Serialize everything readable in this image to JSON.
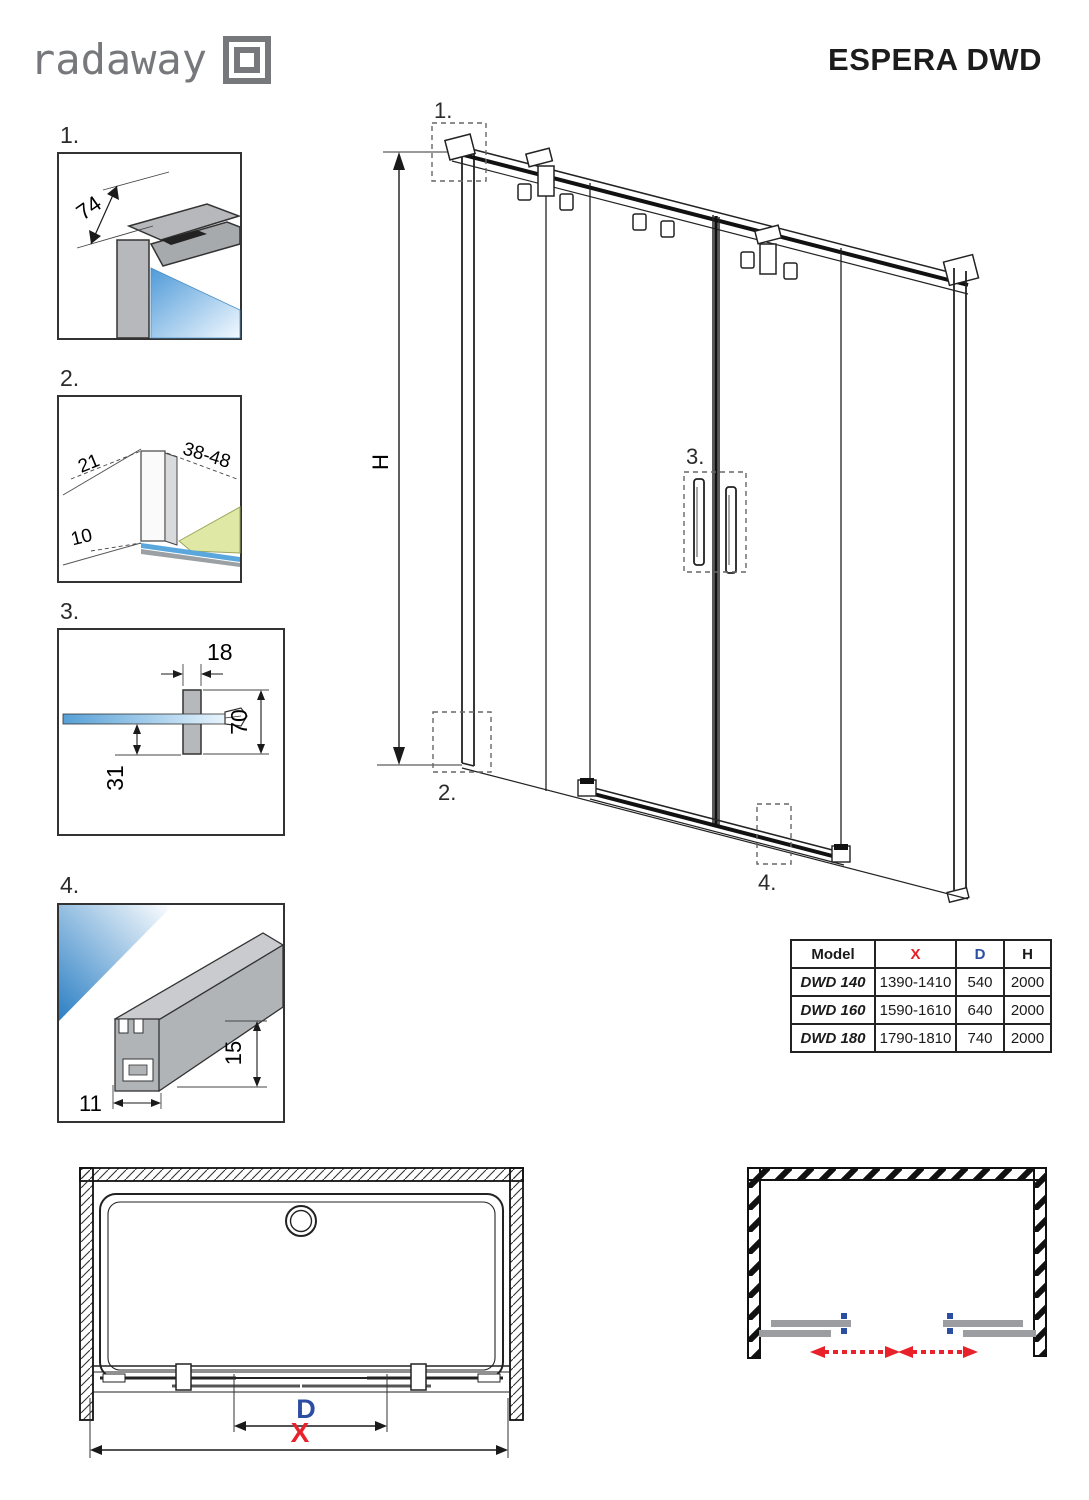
{
  "header": {
    "logo_text": "radaway",
    "title": "ESPERA DWD"
  },
  "details": {
    "d1": {
      "label": "1.",
      "dim74": "74"
    },
    "d2": {
      "label": "2.",
      "dim21": "21",
      "dim3848": "38-48",
      "dim10": "10"
    },
    "d3": {
      "label": "3.",
      "dim18": "18",
      "dim70": "70",
      "dim31": "31"
    },
    "d4": {
      "label": "4.",
      "dim11": "11",
      "dim15": "15"
    }
  },
  "main": {
    "h_label": "H",
    "callouts": {
      "c1": "1.",
      "c2": "2.",
      "c3": "3.",
      "c4": "4."
    }
  },
  "table": {
    "headers": {
      "model": "Model",
      "x": "X",
      "d": "D",
      "h": "H"
    },
    "rows": [
      {
        "model": "DWD 140",
        "x": "1390-1410",
        "d": "540",
        "h": "2000"
      },
      {
        "model": "DWD 160",
        "x": "1590-1610",
        "d": "640",
        "h": "2000"
      },
      {
        "model": "DWD 180",
        "x": "1790-1810",
        "d": "740",
        "h": "2000"
      }
    ]
  },
  "top_view": {
    "dim_d": "D",
    "dim_x": "X"
  },
  "colors": {
    "accent_red": "#e8212a",
    "accent_blue": "#2b4ea2",
    "profile_gray": "#b1b4b7",
    "logo_gray": "#77787b",
    "line_black": "#1a1a1a",
    "glass_blue": "#2e86c8",
    "floor_green": "#e0e8a6"
  }
}
